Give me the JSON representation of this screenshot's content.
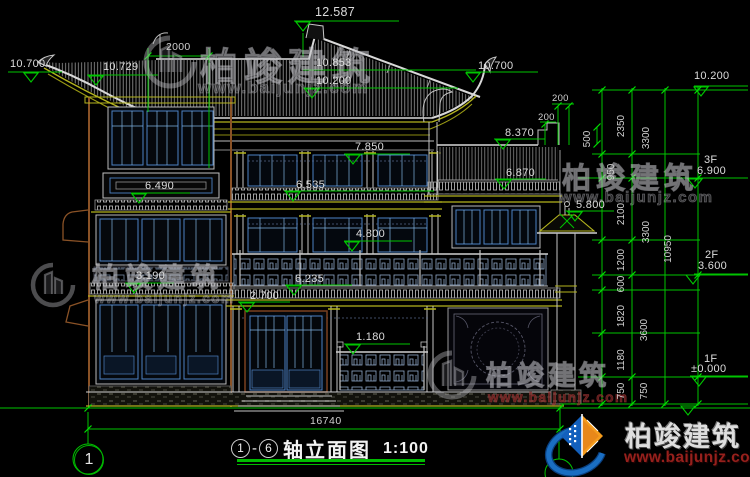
{
  "watermark": {
    "brand": "柏竣建筑",
    "url": "www.baijunjz.com"
  },
  "logo": {
    "brand": "柏竣建筑",
    "url": "www.baijunjz.com"
  },
  "axis": {
    "left": "1",
    "right": "6"
  },
  "title": {
    "axis_left": "1",
    "dash": "-",
    "axis_right": "6",
    "name": "轴立面图",
    "scale": "1:100"
  },
  "ground_dim": "16740",
  "elevations": [
    "12.587",
    "10.700",
    "10.729",
    "10.853",
    "10.200",
    "10.700",
    "8.370",
    "7.850",
    "6.870",
    "6.535",
    "6.490",
    "5.800",
    "4.800",
    "6.235",
    "3.190",
    "2.700",
    "1.180"
  ],
  "right_top_elevation": "10.200",
  "floors": [
    {
      "label": "3F",
      "value": "6.900"
    },
    {
      "label": "2F",
      "value": "3.600"
    },
    {
      "label": "1F",
      "value": "±0.000"
    }
  ],
  "h_dims": [
    "2000",
    "200",
    "200"
  ],
  "v_dims": [
    "500",
    "2350",
    "950",
    "2100",
    "1200",
    "600",
    "1820",
    "1180",
    "750",
    "3300",
    "3300",
    "3600",
    "750",
    "10950"
  ]
}
